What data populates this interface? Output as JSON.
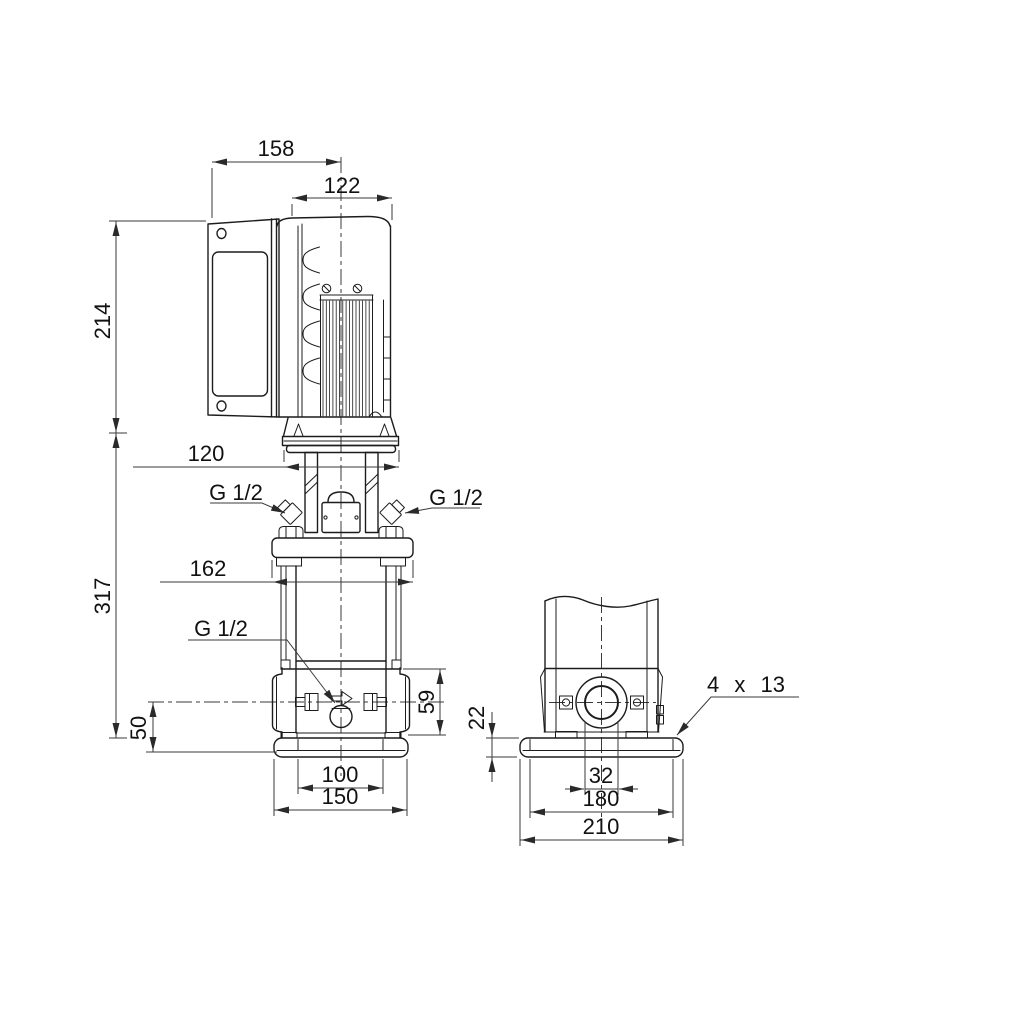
{
  "drawing": {
    "kind": "pump-dimensional-drawing",
    "labels": {
      "dim_158": "158",
      "dim_122": "122",
      "dim_214": "214",
      "dim_120": "120",
      "dim_317": "317",
      "dim_162": "162",
      "dim_50": "50",
      "dim_59": "59",
      "dim_100": "100",
      "dim_150": "150",
      "dim_22": "22",
      "dim_32": "32",
      "dim_180": "180",
      "dim_210": "210",
      "port_top_left": "G 1/2",
      "port_top_right": "G 1/2",
      "drain_port": "G 1/2",
      "base_holes": "4 x 13"
    },
    "colors": {
      "background": "#ffffff",
      "object_line": "#1c1c1c",
      "dimension_line": "#3a3a3a",
      "text": "#111111"
    }
  }
}
